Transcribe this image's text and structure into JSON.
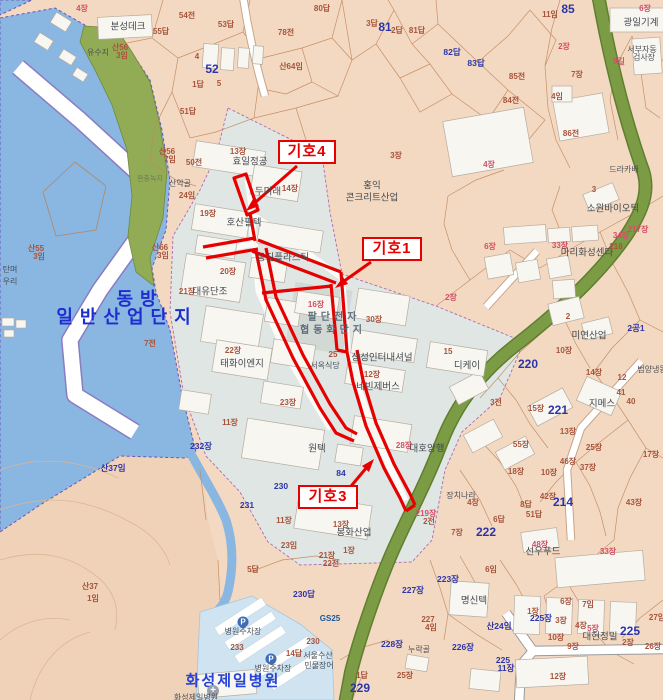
{
  "map": {
    "annotations": {
      "k4": {
        "label": "기호4"
      },
      "k1": {
        "label": "기호1"
      },
      "k3": {
        "label": "기호3"
      }
    },
    "labels": [
      {
        "t": "4장",
        "x": 82,
        "y": 9,
        "c": "pp"
      },
      {
        "t": "80답",
        "x": 322,
        "y": 9,
        "c": "pb"
      },
      {
        "t": "54전",
        "x": 187,
        "y": 16,
        "c": "pb"
      },
      {
        "t": "53답",
        "x": 226,
        "y": 25,
        "c": "pb"
      },
      {
        "t": "55답",
        "x": 161,
        "y": 32,
        "c": "pb"
      },
      {
        "t": "78전",
        "x": 286,
        "y": 33,
        "c": "pb"
      },
      {
        "t": "분성데크",
        "x": 128,
        "y": 27,
        "c": "nm"
      },
      {
        "t": "유수지",
        "x": 98,
        "y": 53,
        "c": "nm2"
      },
      {
        "t": "산56",
        "x": 120,
        "y": 48,
        "c": "pb"
      },
      {
        "t": "3임",
        "x": 122,
        "y": 56,
        "c": "pb"
      },
      {
        "t": "4",
        "x": 197,
        "y": 57,
        "c": "pb"
      },
      {
        "t": "52",
        "x": 212,
        "y": 69,
        "c": "BL"
      },
      {
        "t": "산64임",
        "x": 291,
        "y": 67,
        "c": "pb"
      },
      {
        "t": "1답",
        "x": 198,
        "y": 85,
        "c": "pb"
      },
      {
        "t": "5",
        "x": 219,
        "y": 84,
        "c": "pb"
      },
      {
        "t": "51답",
        "x": 188,
        "y": 112,
        "c": "pb"
      },
      {
        "t": "3답",
        "x": 372,
        "y": 24,
        "c": "pb"
      },
      {
        "t": "81",
        "x": 385,
        "y": 27,
        "c": "BL"
      },
      {
        "t": "2답",
        "x": 397,
        "y": 31,
        "c": "pb"
      },
      {
        "t": "81답",
        "x": 417,
        "y": 31,
        "c": "pb"
      },
      {
        "t": "82답",
        "x": 452,
        "y": 52,
        "c": "bl"
      },
      {
        "t": "83답",
        "x": 476,
        "y": 63,
        "c": "bl"
      },
      {
        "t": "85전",
        "x": 517,
        "y": 77,
        "c": "pb"
      },
      {
        "t": "84전",
        "x": 511,
        "y": 101,
        "c": "pb"
      },
      {
        "t": "86전",
        "x": 571,
        "y": 134,
        "c": "pb"
      },
      {
        "t": "85",
        "x": 568,
        "y": 9,
        "c": "BL"
      },
      {
        "t": "11임",
        "x": 550,
        "y": 15,
        "c": "pb"
      },
      {
        "t": "6장",
        "x": 645,
        "y": 9,
        "c": "pp"
      },
      {
        "t": "광일기계",
        "x": 641,
        "y": 23,
        "c": "nm"
      },
      {
        "t": "2장",
        "x": 564,
        "y": 47,
        "c": "pp"
      },
      {
        "t": "서부자동",
        "x": 642,
        "y": 50,
        "c": "nm2"
      },
      {
        "t": "검사장",
        "x": 644,
        "y": 58,
        "c": "nm2"
      },
      {
        "t": "9길",
        "x": 619,
        "y": 62,
        "c": "pp"
      },
      {
        "t": "7장",
        "x": 577,
        "y": 75,
        "c": "pb"
      },
      {
        "t": "4임",
        "x": 557,
        "y": 97,
        "c": "pb"
      },
      {
        "t": "드라카배",
        "x": 624,
        "y": 170,
        "c": "nm2"
      },
      {
        "t": "산56",
        "x": 167,
        "y": 152,
        "c": "pb"
      },
      {
        "t": "7임",
        "x": 170,
        "y": 160,
        "c": "pb"
      },
      {
        "t": "50전",
        "x": 194,
        "y": 163,
        "c": "pb"
      },
      {
        "t": "13장",
        "x": 238,
        "y": 152,
        "c": "pb"
      },
      {
        "t": "효일정공",
        "x": 250,
        "y": 162,
        "c": "nm"
      },
      {
        "t": "1장",
        "x": 330,
        "y": 155,
        "c": "pb"
      },
      {
        "t": "3장",
        "x": 396,
        "y": 156,
        "c": "pb"
      },
      {
        "t": "4장",
        "x": 489,
        "y": 165,
        "c": "pp"
      },
      {
        "t": "홍익",
        "x": 372,
        "y": 186,
        "c": "nm"
      },
      {
        "t": "콘크리트산업",
        "x": 372,
        "y": 198,
        "c": "nm"
      },
      {
        "t": "소원바이오틱",
        "x": 613,
        "y": 209,
        "c": "nm"
      },
      {
        "t": "3",
        "x": 594,
        "y": 190,
        "c": "pb"
      },
      {
        "t": "산악골",
        "x": 180,
        "y": 184,
        "c": "nm2"
      },
      {
        "t": "24임",
        "x": 187,
        "y": 196,
        "c": "pb"
      },
      {
        "t": "완충녹지",
        "x": 150,
        "y": 179,
        "c": "nm3"
      },
      {
        "t": "두미래",
        "x": 268,
        "y": 192,
        "c": "nm"
      },
      {
        "t": "14장",
        "x": 290,
        "y": 189,
        "c": "pb"
      },
      {
        "t": "19장",
        "x": 208,
        "y": 214,
        "c": "pb"
      },
      {
        "t": "호산필텍",
        "x": 244,
        "y": 223,
        "c": "nm"
      },
      {
        "t": "산66",
        "x": 160,
        "y": 248,
        "c": "pb"
      },
      {
        "t": "3임",
        "x": 163,
        "y": 256,
        "c": "pb"
      },
      {
        "t": "20장",
        "x": 228,
        "y": 272,
        "c": "pb"
      },
      {
        "t": "21장",
        "x": 187,
        "y": 292,
        "c": "pb"
      },
      {
        "t": "대유단조",
        "x": 210,
        "y": 292,
        "c": "nm"
      },
      {
        "t": "동진플라스틱",
        "x": 283,
        "y": 258,
        "c": "nm"
      },
      {
        "t": "16장",
        "x": 316,
        "y": 305,
        "c": "pp"
      },
      {
        "t": "팔단전자",
        "x": 334,
        "y": 318,
        "c": "nmB"
      },
      {
        "t": "협동화단지",
        "x": 333,
        "y": 331,
        "c": "nmB"
      },
      {
        "t": "30장",
        "x": 374,
        "y": 320,
        "c": "pb"
      },
      {
        "t": "2장",
        "x": 451,
        "y": 298,
        "c": "pp"
      },
      {
        "t": "6장",
        "x": 490,
        "y": 247,
        "c": "pp"
      },
      {
        "t": "34장",
        "x": 621,
        "y": 236,
        "c": "pp"
      },
      {
        "t": "217장",
        "x": 638,
        "y": 230,
        "c": "pp"
      },
      {
        "t": "33장",
        "x": 560,
        "y": 246,
        "c": "pp"
      },
      {
        "t": "마리화성센타",
        "x": 587,
        "y": 253,
        "c": "nm"
      },
      {
        "t": "218",
        "x": 616,
        "y": 247,
        "c": "pb"
      },
      {
        "t": "2",
        "x": 568,
        "y": 317,
        "c": "pb"
      },
      {
        "t": "미연산업",
        "x": 589,
        "y": 336,
        "c": "nm"
      },
      {
        "t": "2공1",
        "x": 636,
        "y": 328,
        "c": "bl"
      },
      {
        "t": "15",
        "x": 448,
        "y": 352,
        "c": "pb"
      },
      {
        "t": "10장",
        "x": 564,
        "y": 351,
        "c": "pb"
      },
      {
        "t": "7전",
        "x": 150,
        "y": 344,
        "c": "pb"
      },
      {
        "t": "22장",
        "x": 233,
        "y": 351,
        "c": "pb"
      },
      {
        "t": "태화이엔지",
        "x": 242,
        "y": 364,
        "c": "nm"
      },
      {
        "t": "25",
        "x": 333,
        "y": 355,
        "c": "pb"
      },
      {
        "t": "서옥식당",
        "x": 325,
        "y": 366,
        "c": "nm2"
      },
      {
        "t": "상성인터내셔널",
        "x": 382,
        "y": 358,
        "c": "nm"
      },
      {
        "t": "12장",
        "x": 372,
        "y": 375,
        "c": "pb"
      },
      {
        "t": "네빈제버스",
        "x": 378,
        "y": 387,
        "c": "nm"
      },
      {
        "t": "디케이",
        "x": 467,
        "y": 366,
        "c": "nm"
      },
      {
        "t": "220",
        "x": 528,
        "y": 364,
        "c": "BL"
      },
      {
        "t": "14장",
        "x": 594,
        "y": 373,
        "c": "pb"
      },
      {
        "t": "범양냉동",
        "x": 652,
        "y": 370,
        "c": "nm2"
      },
      {
        "t": "12",
        "x": 622,
        "y": 378,
        "c": "pb"
      },
      {
        "t": "41",
        "x": 621,
        "y": 393,
        "c": "pb"
      },
      {
        "t": "40",
        "x": 631,
        "y": 402,
        "c": "pb"
      },
      {
        "t": "지메스",
        "x": 602,
        "y": 404,
        "c": "nm"
      },
      {
        "t": "221",
        "x": 558,
        "y": 410,
        "c": "BL"
      },
      {
        "t": "15장",
        "x": 536,
        "y": 409,
        "c": "pb"
      },
      {
        "t": "3전",
        "x": 496,
        "y": 403,
        "c": "pb"
      },
      {
        "t": "13장",
        "x": 568,
        "y": 432,
        "c": "pb"
      },
      {
        "t": "55장",
        "x": 521,
        "y": 445,
        "c": "pb"
      },
      {
        "t": "25장",
        "x": 594,
        "y": 448,
        "c": "pb"
      },
      {
        "t": "17장",
        "x": 651,
        "y": 455,
        "c": "pb"
      },
      {
        "t": "46장",
        "x": 568,
        "y": 462,
        "c": "pb"
      },
      {
        "t": "37장",
        "x": 588,
        "y": 468,
        "c": "pb"
      },
      {
        "t": "18장",
        "x": 516,
        "y": 472,
        "c": "pb"
      },
      {
        "t": "10장",
        "x": 549,
        "y": 473,
        "c": "pb"
      },
      {
        "t": "42장",
        "x": 548,
        "y": 497,
        "c": "pb"
      },
      {
        "t": "214",
        "x": 563,
        "y": 502,
        "c": "BL"
      },
      {
        "t": "43장",
        "x": 634,
        "y": 503,
        "c": "pb"
      },
      {
        "t": "장치나라",
        "x": 461,
        "y": 496,
        "c": "nm2"
      },
      {
        "t": "4장",
        "x": 473,
        "y": 503,
        "c": "pb"
      },
      {
        "t": "8답",
        "x": 526,
        "y": 505,
        "c": "pb"
      },
      {
        "t": "51답",
        "x": 534,
        "y": 515,
        "c": "pb"
      },
      {
        "t": "6답",
        "x": 499,
        "y": 520,
        "c": "pb"
      },
      {
        "t": "222",
        "x": 486,
        "y": 532,
        "c": "BL"
      },
      {
        "t": "7장",
        "x": 457,
        "y": 533,
        "c": "pb"
      },
      {
        "t": "23장",
        "x": 288,
        "y": 403,
        "c": "pb"
      },
      {
        "t": "원텍",
        "x": 317,
        "y": 449,
        "c": "nm"
      },
      {
        "t": "84",
        "x": 341,
        "y": 473,
        "c": "bl"
      },
      {
        "t": "28장",
        "x": 404,
        "y": 446,
        "c": "pp"
      },
      {
        "t": "대호양행",
        "x": 427,
        "y": 449,
        "c": "nm"
      },
      {
        "t": "11장",
        "x": 230,
        "y": 423,
        "c": "pb"
      },
      {
        "t": "232장",
        "x": 201,
        "y": 446,
        "c": "bl"
      },
      {
        "t": "230",
        "x": 281,
        "y": 486,
        "c": "bl"
      },
      {
        "t": "231",
        "x": 247,
        "y": 505,
        "c": "bl"
      },
      {
        "t": "11장",
        "x": 284,
        "y": 521,
        "c": "pb"
      },
      {
        "t": "23임",
        "x": 289,
        "y": 546,
        "c": "pb"
      },
      {
        "t": "21장",
        "x": 327,
        "y": 556,
        "c": "pb"
      },
      {
        "t": "22전",
        "x": 331,
        "y": 564,
        "c": "pb"
      },
      {
        "t": "13장",
        "x": 341,
        "y": 525,
        "c": "pb"
      },
      {
        "t": "봉화산업",
        "x": 354,
        "y": 533,
        "c": "nm"
      },
      {
        "t": "1장",
        "x": 349,
        "y": 551,
        "c": "pb"
      },
      {
        "t": "219장",
        "x": 426,
        "y": 514,
        "c": "pp"
      },
      {
        "t": "2전",
        "x": 429,
        "y": 522,
        "c": "pb"
      },
      {
        "t": "동방",
        "x": 140,
        "y": 299,
        "c": "wb1"
      },
      {
        "t": "일반산업단지",
        "x": 127,
        "y": 317,
        "c": "wb2"
      },
      {
        "t": "산55",
        "x": 36,
        "y": 249,
        "c": "pb"
      },
      {
        "t": "3임",
        "x": 39,
        "y": 257,
        "c": "pb"
      },
      {
        "t": "탄며",
        "x": 10,
        "y": 270,
        "c": "nm2"
      },
      {
        "t": "우리",
        "x": 10,
        "y": 282,
        "c": "nm2"
      },
      {
        "t": "산37임",
        "x": 113,
        "y": 468,
        "c": "bl"
      },
      {
        "t": "산37",
        "x": 90,
        "y": 587,
        "c": "pb"
      },
      {
        "t": "1임",
        "x": 93,
        "y": 599,
        "c": "pb"
      },
      {
        "t": "48장",
        "x": 540,
        "y": 545,
        "c": "pp"
      },
      {
        "t": "선우푸드",
        "x": 543,
        "y": 552,
        "c": "nm"
      },
      {
        "t": "33장",
        "x": 608,
        "y": 552,
        "c": "pp"
      },
      {
        "t": "6임",
        "x": 491,
        "y": 570,
        "c": "pb"
      },
      {
        "t": "223장",
        "x": 448,
        "y": 579,
        "c": "bl"
      },
      {
        "t": "227장",
        "x": 413,
        "y": 590,
        "c": "bl"
      },
      {
        "t": "명신텍",
        "x": 474,
        "y": 601,
        "c": "nm"
      },
      {
        "t": "227",
        "x": 428,
        "y": 620,
        "c": "pb"
      },
      {
        "t": "4임",
        "x": 431,
        "y": 628,
        "c": "pb"
      },
      {
        "t": "산24임",
        "x": 499,
        "y": 626,
        "c": "bl"
      },
      {
        "t": "226장",
        "x": 463,
        "y": 647,
        "c": "bl"
      },
      {
        "t": "누락골",
        "x": 419,
        "y": 650,
        "c": "nm2"
      },
      {
        "t": "1장",
        "x": 533,
        "y": 612,
        "c": "pb"
      },
      {
        "t": "225장",
        "x": 541,
        "y": 618,
        "c": "bl"
      },
      {
        "t": "3장",
        "x": 561,
        "y": 621,
        "c": "pb"
      },
      {
        "t": "6장",
        "x": 566,
        "y": 602,
        "c": "pb"
      },
      {
        "t": "7임",
        "x": 588,
        "y": 605,
        "c": "pb"
      },
      {
        "t": "4장",
        "x": 581,
        "y": 626,
        "c": "pb"
      },
      {
        "t": "5장",
        "x": 593,
        "y": 629,
        "c": "pp"
      },
      {
        "t": "대현정밀",
        "x": 600,
        "y": 637,
        "c": "nm"
      },
      {
        "t": "225",
        "x": 630,
        "y": 631,
        "c": "BL"
      },
      {
        "t": "2장",
        "x": 628,
        "y": 643,
        "c": "pb"
      },
      {
        "t": "26장",
        "x": 653,
        "y": 647,
        "c": "pb"
      },
      {
        "t": "27임",
        "x": 657,
        "y": 618,
        "c": "pb"
      },
      {
        "t": "10장",
        "x": 556,
        "y": 638,
        "c": "pb"
      },
      {
        "t": "9장",
        "x": 573,
        "y": 647,
        "c": "pb"
      },
      {
        "t": "225",
        "x": 503,
        "y": 660,
        "c": "bl"
      },
      {
        "t": "11장",
        "x": 506,
        "y": 668,
        "c": "bl"
      },
      {
        "t": "12장",
        "x": 558,
        "y": 677,
        "c": "pb"
      },
      {
        "t": "25장",
        "x": 405,
        "y": 676,
        "c": "pb"
      },
      {
        "t": "228장",
        "x": 392,
        "y": 644,
        "c": "bl"
      },
      {
        "t": "229",
        "x": 360,
        "y": 688,
        "c": "BL"
      },
      {
        "t": "1답",
        "x": 362,
        "y": 676,
        "c": "pb"
      },
      {
        "t": "230답",
        "x": 304,
        "y": 594,
        "c": "bl"
      },
      {
        "t": "5답",
        "x": 253,
        "y": 570,
        "c": "pb"
      },
      {
        "t": "233",
        "x": 237,
        "y": 648,
        "c": "pb"
      },
      {
        "t": "GS25",
        "x": 330,
        "y": 619,
        "c": "gs"
      },
      {
        "t": "230",
        "x": 313,
        "y": 642,
        "c": "pb"
      },
      {
        "t": "14답",
        "x": 294,
        "y": 654,
        "c": "pb"
      },
      {
        "t": "서울수산",
        "x": 318,
        "y": 656,
        "c": "nm2"
      },
      {
        "t": "민물장어",
        "x": 319,
        "y": 666,
        "c": "nm2"
      },
      {
        "t": "P",
        "x": 243,
        "y": 622,
        "c": "pico"
      },
      {
        "t": "병원주차장",
        "x": 243,
        "y": 632,
        "c": "nm2"
      },
      {
        "t": "P",
        "x": 271,
        "y": 659,
        "c": "pico"
      },
      {
        "t": "병원주차장",
        "x": 273,
        "y": 669,
        "c": "nm2"
      },
      {
        "t": "화성제일병원",
        "x": 233,
        "y": 681,
        "c": "hosp"
      },
      {
        "t": "+",
        "x": 213,
        "y": 691,
        "c": "hico"
      },
      {
        "t": "화성제일병원",
        "x": 196,
        "y": 698,
        "c": "nm2"
      }
    ]
  },
  "colors": {
    "annotation_red": "#e60000",
    "water_blue": "#8ab6e2",
    "industrial_gray": "#dfe6e3",
    "road_green": "#7b9c44",
    "park_green": "#92ac55",
    "parcel_number_blue": "#2c35a8",
    "parcel_number_brown": "#a8543c",
    "parcel_number_pink": "#d44f66",
    "facility_text": "#43484f",
    "water_label_blue": "#1e2ed0",
    "hospital_label_blue": "#2742d8",
    "background_peach": "#f3d9c2"
  }
}
